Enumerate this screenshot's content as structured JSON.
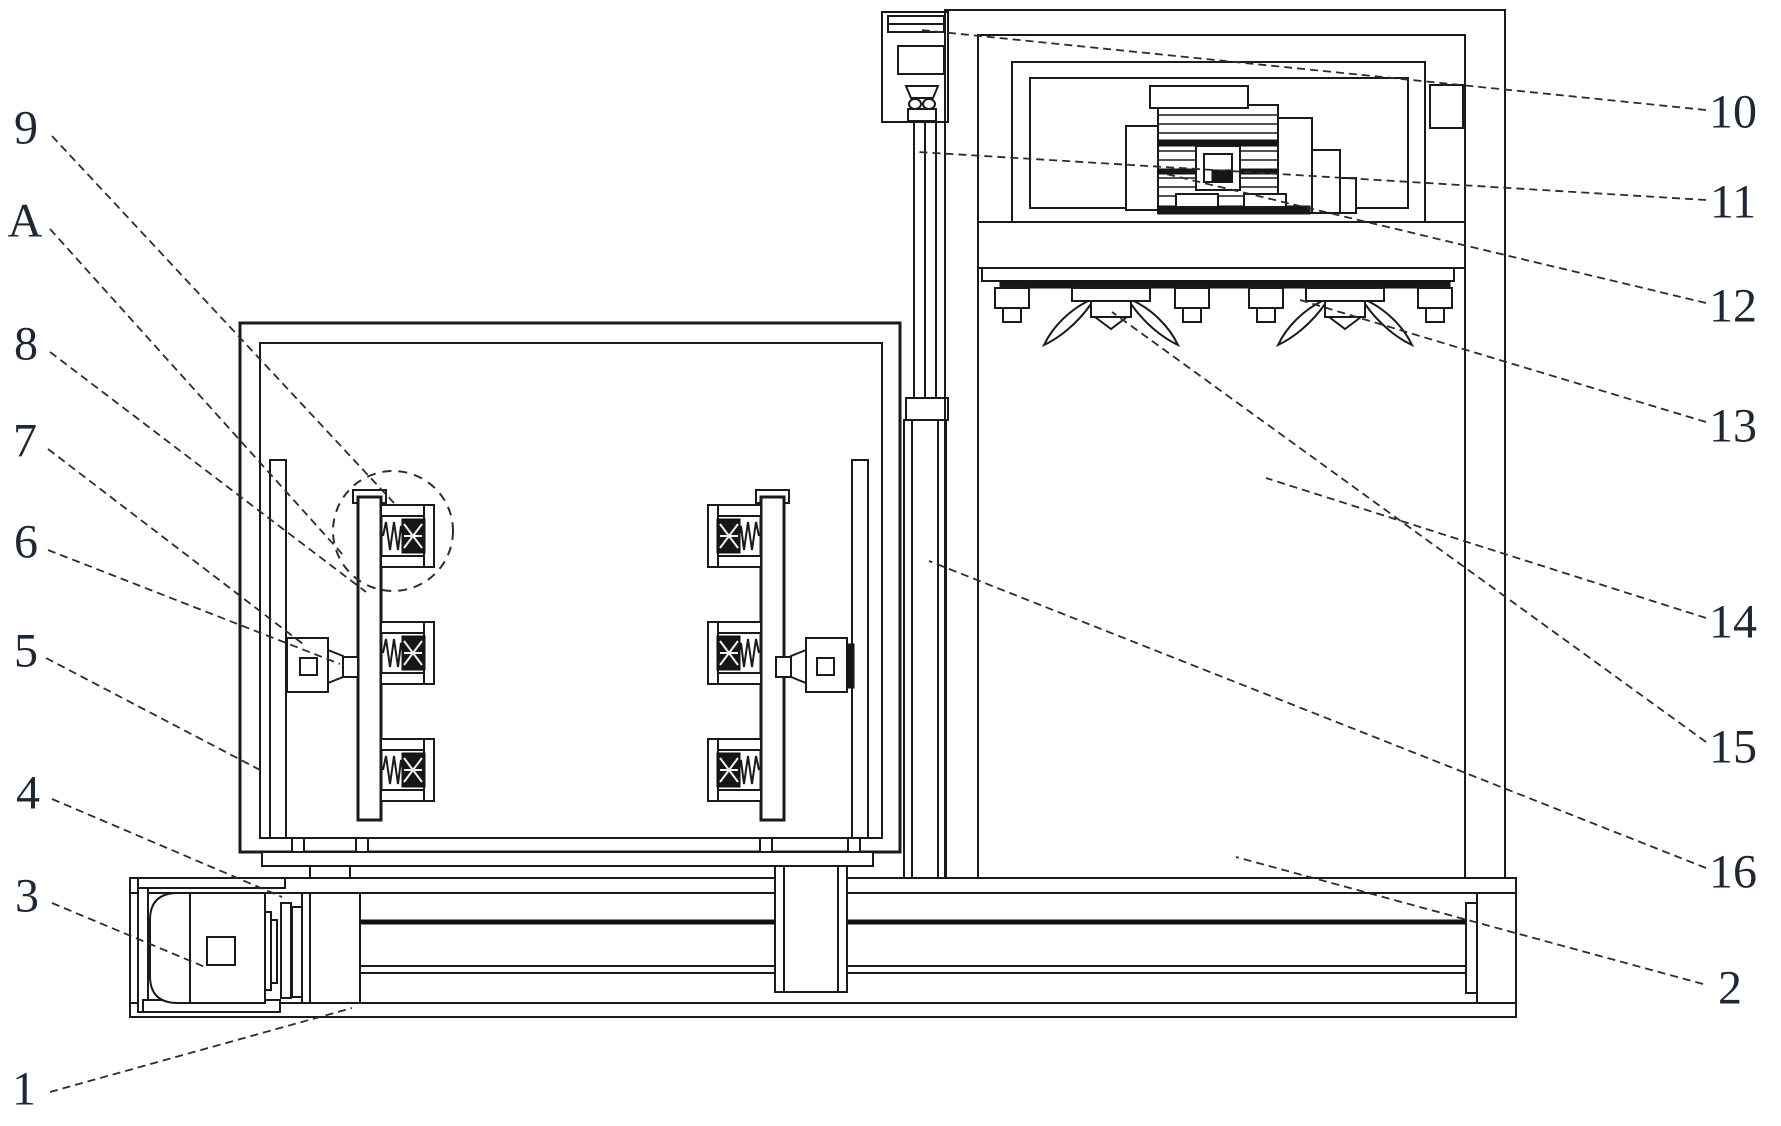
{
  "figure": {
    "colors": {
      "background": "#ffffff",
      "line": "#1a1a1a",
      "label": "#1d2736",
      "leader": "#2c2c2c"
    },
    "detail_circle_label": "A",
    "callouts": [
      {
        "id": "9",
        "text": "9",
        "tx": 26,
        "ty": 128,
        "x1": 52,
        "y1": 136,
        "x2": 394,
        "y2": 503
      },
      {
        "id": "A",
        "text": "A",
        "tx": 25,
        "ty": 221,
        "x1": 50,
        "y1": 229,
        "x2": 344,
        "y2": 556
      },
      {
        "id": "8",
        "text": "8",
        "tx": 26,
        "ty": 344,
        "x1": 50,
        "y1": 352,
        "x2": 366,
        "y2": 592
      },
      {
        "id": "7",
        "text": "7",
        "tx": 25,
        "ty": 441,
        "x1": 48,
        "y1": 449,
        "x2": 303,
        "y2": 644
      },
      {
        "id": "6",
        "text": "6",
        "tx": 26,
        "ty": 542,
        "x1": 48,
        "y1": 550,
        "x2": 340,
        "y2": 664
      },
      {
        "id": "5",
        "text": "5",
        "tx": 26,
        "ty": 651,
        "x1": 46,
        "y1": 658,
        "x2": 262,
        "y2": 771
      },
      {
        "id": "4",
        "text": "4",
        "tx": 28,
        "ty": 793,
        "x1": 52,
        "y1": 799,
        "x2": 282,
        "y2": 897
      },
      {
        "id": "3",
        "text": "3",
        "tx": 27,
        "ty": 896,
        "x1": 52,
        "y1": 903,
        "x2": 205,
        "y2": 967
      },
      {
        "id": "1",
        "text": "1",
        "tx": 24,
        "ty": 1089,
        "x1": 50,
        "y1": 1092,
        "x2": 352,
        "y2": 1008
      },
      {
        "id": "10",
        "text": "10",
        "tx": 1733,
        "ty": 112,
        "x1": 1706,
        "y1": 110,
        "x2": 921,
        "y2": 30
      },
      {
        "id": "11",
        "text": "11",
        "tx": 1733,
        "ty": 202,
        "x1": 1706,
        "y1": 200,
        "x2": 918,
        "y2": 152
      },
      {
        "id": "12",
        "text": "12",
        "tx": 1733,
        "ty": 306,
        "x1": 1706,
        "y1": 303,
        "x2": 1166,
        "y2": 174
      },
      {
        "id": "13",
        "text": "13",
        "tx": 1733,
        "ty": 426,
        "x1": 1706,
        "y1": 422,
        "x2": 1300,
        "y2": 300
      },
      {
        "id": "14",
        "text": "14",
        "tx": 1733,
        "ty": 622,
        "x1": 1706,
        "y1": 618,
        "x2": 1266,
        "y2": 478
      },
      {
        "id": "15",
        "text": "15",
        "tx": 1733,
        "ty": 747,
        "x1": 1706,
        "y1": 742,
        "x2": 1112,
        "y2": 312
      },
      {
        "id": "16",
        "text": "16",
        "tx": 1733,
        "ty": 872,
        "x1": 1706,
        "y1": 868,
        "x2": 929,
        "y2": 561
      },
      {
        "id": "2",
        "text": "2",
        "tx": 1730,
        "ty": 988,
        "x1": 1703,
        "y1": 984,
        "x2": 1236,
        "y2": 857
      }
    ]
  }
}
